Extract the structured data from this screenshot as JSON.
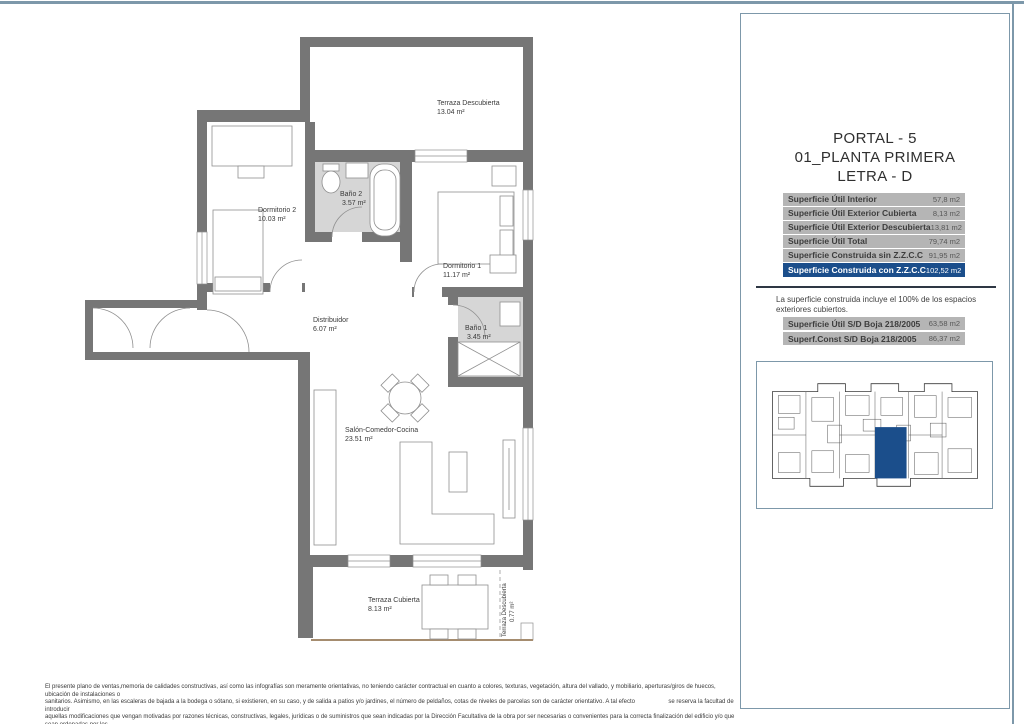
{
  "page": {
    "border_color": "#7d98aa"
  },
  "title_block": {
    "line1": "PORTAL - 5",
    "line2": "01_PLANTA PRIMERA",
    "line3": "LETRA - D"
  },
  "surface_table": {
    "row_bg": "#b5b5b5",
    "highlight_color": "#1b4e8b",
    "rows": [
      {
        "label": "Superficie Útil Interior",
        "value": "57,8 m2"
      },
      {
        "label": "Superficie Útil Exterior Cubierta",
        "value": "8,13 m2"
      },
      {
        "label": "Superficie Útil Exterior Descubierta",
        "value": "13,81 m2"
      },
      {
        "label": "Superficie Útil Total",
        "value": "79,74 m2"
      },
      {
        "label": "Superficie Construida sin Z.Z.C.C",
        "value": "91,95 m2"
      },
      {
        "label": "Superficie Construida con Z.Z.C.C",
        "value": "102,52 m2"
      }
    ]
  },
  "note": "La superficie construida incluye el 100% de los espacios exteriores cubiertos.",
  "boja_table": {
    "rows": [
      {
        "label": "Superficie Útil S/D Boja 218/2005",
        "value": "63,58 m2"
      },
      {
        "label": "Superf.Const S/D Boja 218/2005",
        "value": "86,37 m2"
      }
    ]
  },
  "floor_plan": {
    "wall_color": "#767676",
    "bath_floor_color": "#d6d6d6",
    "rooms": [
      {
        "name": "Terraza Descubierta",
        "area": "13.04 m²"
      },
      {
        "name": "Dormitorio 2",
        "area": "10.03 m²"
      },
      {
        "name": "Baño 2",
        "area": "3.57 m²"
      },
      {
        "name": "Dormitorio 1",
        "area": "11.17 m²"
      },
      {
        "name": "Distribuidor",
        "area": "6.07 m²"
      },
      {
        "name": "Baño 1",
        "area": "3.45 m²"
      },
      {
        "name": "Salón-Comedor-Cocina",
        "area": "23.51 m²"
      },
      {
        "name": "Terraza Cubierta",
        "area": "8.13 m²"
      },
      {
        "name": "Terraza Descubierta",
        "area": "0.77 m²"
      }
    ]
  },
  "key_plan": {
    "highlight_color": "#1b4e8b"
  },
  "disclaimer": {
    "line1": "El presente plano de ventas,memoria de calidades constructivas, así como las infografías son meramente orientativas, no teniendo carácter contractual en cuanto a colores, texturas, vegetación, altura del vallado, y mobiliario, aperturas/giros de huecos, ubicación de instalaciones o",
    "line2": "sanitarios. Asimismo, en las escaleras de bajada a la bodega o sótano, si existieren, en su caso, y de salida a patios y/o jardines, el número de peldaños, cotas de niveles de parcelas son de carácter orientativo. A tal efecto                    se reserva la facultad de introducir",
    "line3": "aquellas modificaciones que vengan motivadas por razones técnicas, constructivas, legales, jurídicas o de suministros que sean indicadas por la Dirección Facultativa de la obra por ser necesarias o convenientes para la correcta finalización del edificio y/o que sean ordenadas por los",
    "line4": "organismos públicos competentes."
  }
}
